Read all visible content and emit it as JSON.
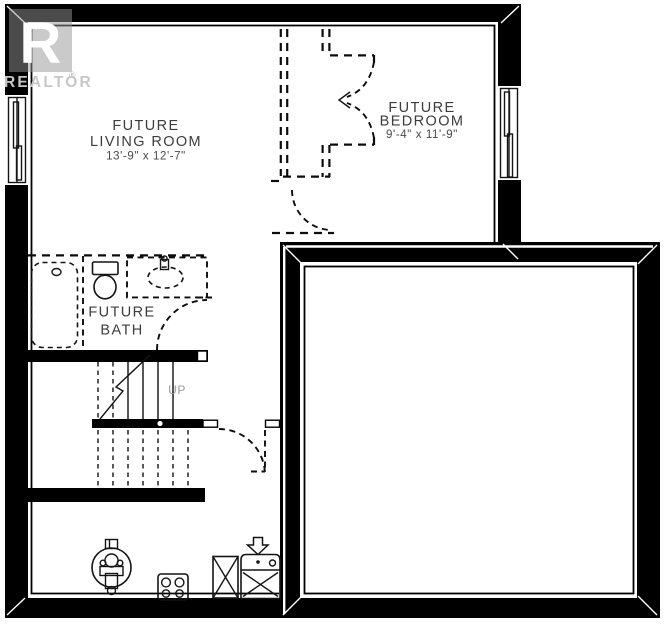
{
  "branding": {
    "logo_letter": "R",
    "logo_text": "REALTOR",
    "registered_mark": "®",
    "watermark_color": "#c7c7c7"
  },
  "rooms": {
    "living_room": {
      "line1": "FUTURE",
      "line2": "LIVING ROOM",
      "dimensions": "13'-9\" x 12'-7\""
    },
    "bedroom": {
      "line1": "FUTURE",
      "line2": "BEDROOM",
      "dimensions": "9'-4\" x 11'-9\""
    },
    "bath": {
      "line1": "FUTURE",
      "line2": "BATH"
    },
    "stairs": {
      "direction_label": "UP"
    }
  },
  "colors": {
    "wall": "#000000",
    "line": "#141414",
    "room_label": "#3d3d3d",
    "dimension_label": "#4a4a4a",
    "muted_label": "#9b9b9b",
    "watermark": "#c7c7c7",
    "background": "#ffffff"
  }
}
